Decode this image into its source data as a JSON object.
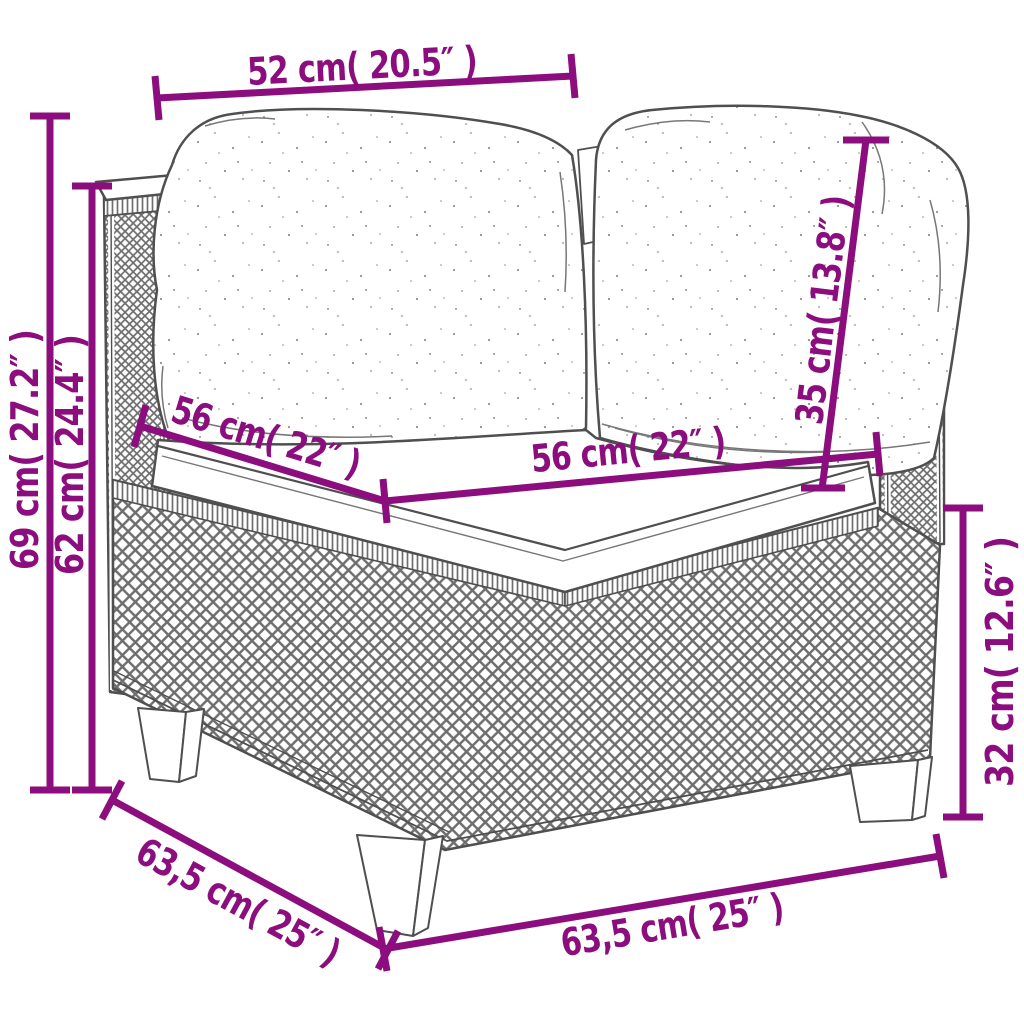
{
  "page": {
    "background": "#ffffff"
  },
  "colors": {
    "dimension_annotation": "#8c0d7e",
    "line_art": "#4f4f4f",
    "weave_line": "#6e6e6e"
  },
  "diagram": {
    "subject": "poly rattan corner sofa module with back cushions and seat cushion",
    "dims": {
      "cushion_width_top": "52 cm( 20.5″ )",
      "total_height": "69 cm( 27.2″ )",
      "arm_height": "62 cm( 24.4″ )",
      "seat_depth": "56 cm( 22″ )",
      "seat_width": "56 cm( 22″ )",
      "back_cushion_height": "35 cm( 13.8″ )",
      "base_height": "32 cm( 12.6″ )",
      "base_depth": "63,5 cm( 25″ )",
      "base_width": "63,5 cm( 25″ )"
    }
  }
}
